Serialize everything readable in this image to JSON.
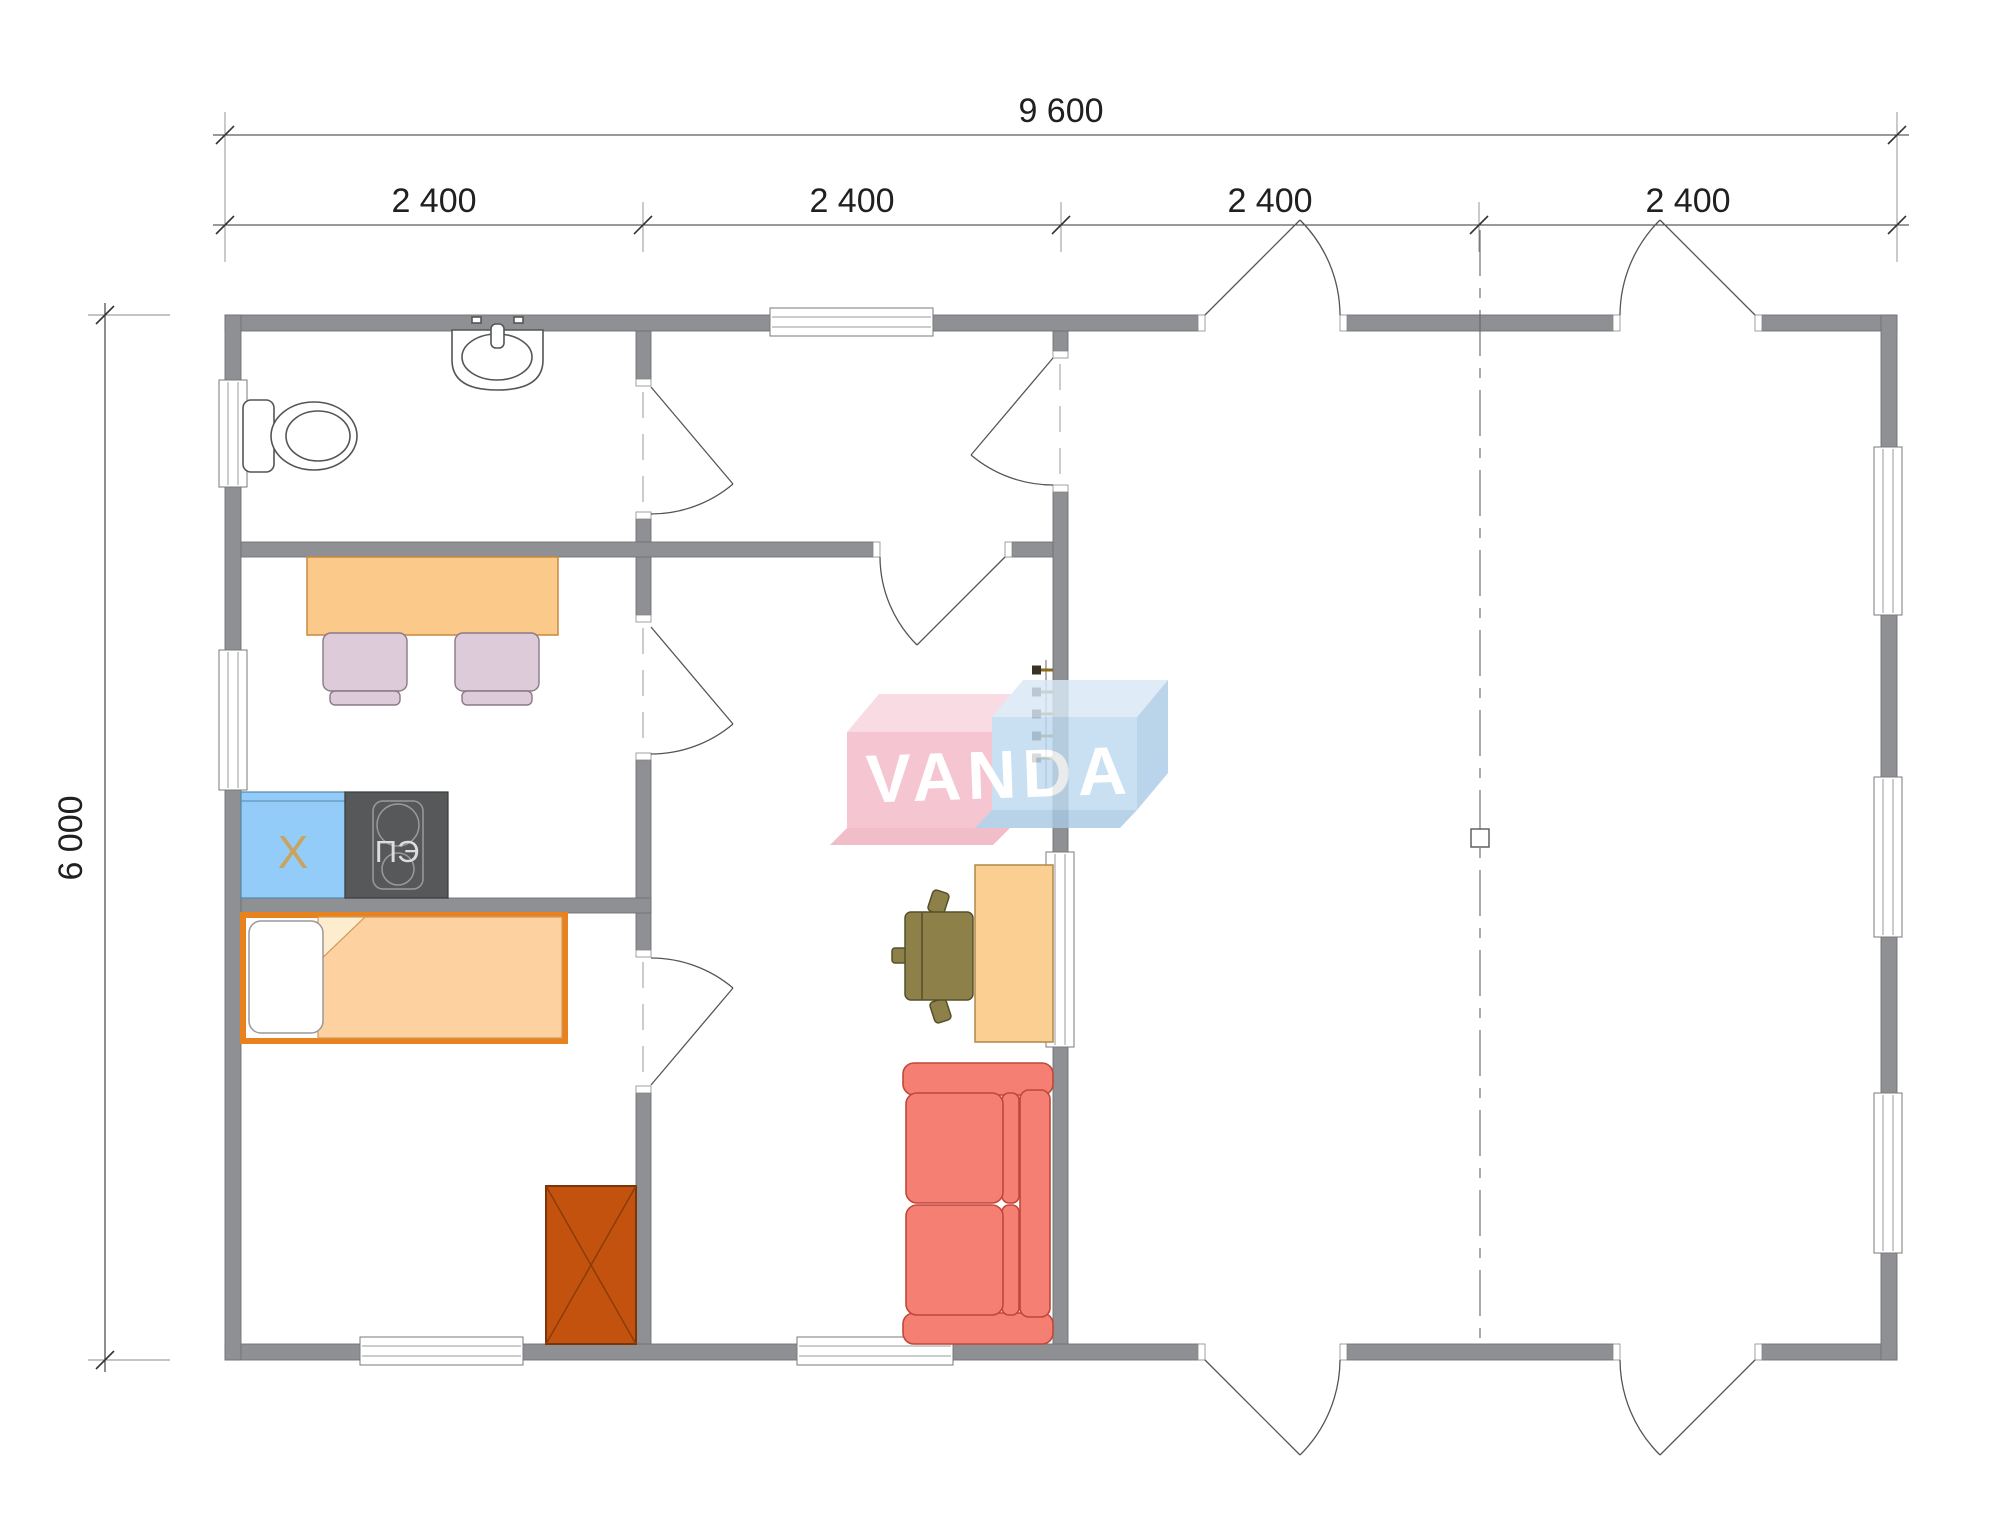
{
  "dimensions": {
    "total_width": "9 600",
    "segments": [
      "2 400",
      "2 400",
      "2 400",
      "2 400"
    ],
    "total_height": "6 000"
  },
  "watermark": {
    "text": "VANDA",
    "pink": "#f3bac7",
    "blue": "#bedaf0"
  },
  "appliances": {
    "fridge_label": "X",
    "stove_label": "ПЭ"
  },
  "colors": {
    "wall": "#8e9093",
    "dimension_text": "#202020",
    "kitchen_table": "#fbc98a",
    "kitchen_chair": "#ddcbd9",
    "fridge": "#93ccf9",
    "fridge_label": "#c9a35f",
    "stove": "#57585a",
    "bed_frame": "#e8821e",
    "bed_blanket": "#fdd2a0",
    "wardrobe": "#c4520f",
    "desk": "#fbcf92",
    "desk_chair": "#8d8048",
    "sofa": "#f57f72",
    "ladder_rung": "#8a6a20"
  }
}
